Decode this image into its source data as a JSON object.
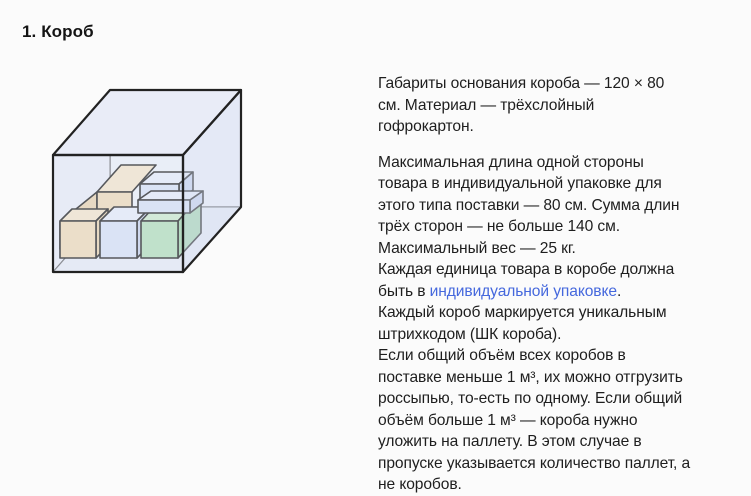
{
  "page": {
    "background_color": "#fbfbfb",
    "text_color": "#1e1e1e",
    "link_color": "#4568dd"
  },
  "heading": "1. Короб",
  "illustration": {
    "name": "carton-box-with-parcels",
    "colors": {
      "outline": "#222222",
      "thin_edge": "#3a3a3a",
      "glass_top": "#e9ecf7",
      "glass_back": "#eef1f9",
      "glass_left": "#ebeef7",
      "glass_floor": "#e8ecf6",
      "glass_front_tint": "rgba(223,229,245,0.28)",
      "glass_right_tint": "rgba(216,223,242,0.45)",
      "tan_front": "#f0dbb9",
      "tan_top": "#f6e7cc",
      "tan_side": "#ebd5b1",
      "blue_front": "#d9e2f6",
      "blue_top": "#e8edfa",
      "blue_side": "#c9d4ee",
      "green_front": "#b4dfbc",
      "green_top": "#cdeace",
      "green_side": "#a6d6af"
    }
  },
  "article": {
    "p1": {
      "lines": [
        "Габариты основания короба — 120 × 80",
        "см. Материал — трёхслойный",
        "гофрокартон."
      ]
    },
    "p2": {
      "lines_a": [
        "Максимальная длина одной стороны",
        "товара в индивидуальной упаковке для",
        "этого типа поставки — 80 см. Сумма длин",
        "трёх сторон — не больше 140 см.",
        "Максимальный вес — 25 кг.",
        "Каждая единица товара в коробе должна"
      ],
      "link_line": {
        "prefix": "быть в ",
        "link": "индивидуальной упаковке",
        "suffix": "."
      },
      "lines_b": [
        "Каждый короб маркируется уникальным",
        "штрихкодом (ШК короба).",
        "Если общий объём всех коробов в",
        "поставке меньше 1 м³, их можно отгрузить",
        "россыпью, то-есть по одному. Если общий",
        "объём больше 1 м³ — короба нужно",
        "уложить на паллету. В этом случае в",
        "пропуске указывается количество паллет, а",
        "не коробов."
      ]
    }
  }
}
